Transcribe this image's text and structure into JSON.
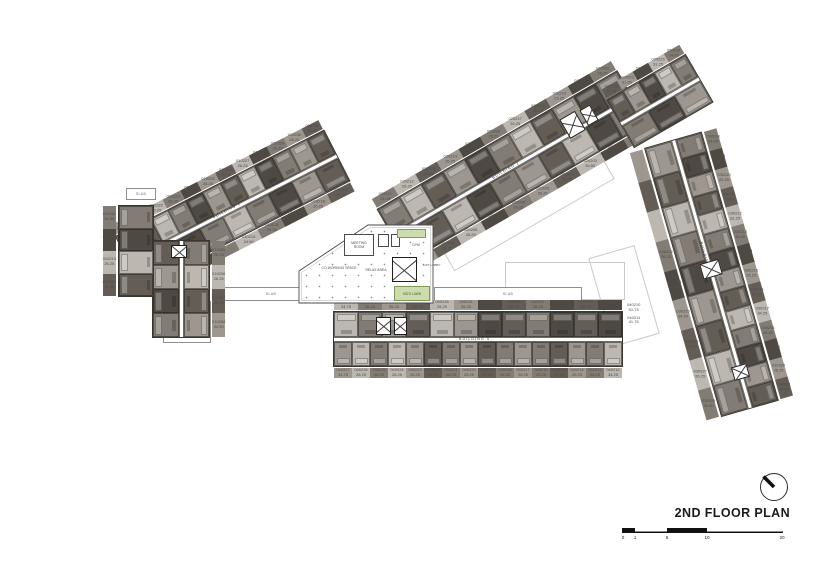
{
  "title": "2ND FLOOR PLAN",
  "scale_bar": {
    "ticks": [
      "0",
      "1",
      "5",
      "10",
      "20"
    ]
  },
  "amenity": {
    "meeting_room": "MEETING ROOM",
    "gym": "GYM",
    "coworking": "CO-WORKING SPACE",
    "relax_area": "RELAX AREA",
    "kids_lawn": "KID'S LAWN",
    "lift_lobby": "LIFT LOBBY",
    "slab": "SLAB"
  },
  "palette": {
    "unit_shades": [
      "#4f4943",
      "#645d56",
      "#837c74",
      "#9e978f",
      "#bcb7b0",
      "#d3cfc9"
    ],
    "lawn_green": "#ccdcae"
  },
  "buildings": {
    "b1": {
      "name": "BUILDING 1",
      "diag_top": [
        {
          "c": "010220",
          "a": "26.25",
          "s": 3
        },
        {
          "c": "010221",
          "a": "26.25",
          "s": 1
        },
        {
          "c": "010222",
          "a": "26.25",
          "s": 4
        },
        {
          "c": "010223",
          "a": "26.25",
          "s": 2
        },
        {
          "c": "010224",
          "a": "26.25",
          "s": 0
        },
        {
          "c": "010225",
          "a": "26.25",
          "s": 3
        },
        {
          "c": "010226",
          "a": "26.25",
          "s": 1
        },
        {
          "c": "010227",
          "a": "26.25",
          "s": 4
        },
        {
          "c": "010228",
          "a": "34.50",
          "s": 0
        },
        {
          "c": "010229",
          "a": "26.25",
          "s": 2
        },
        {
          "c": "010230",
          "a": "26.25",
          "s": 3
        },
        {
          "c": "010231",
          "a": "34.50",
          "s": 1
        }
      ],
      "diag_bot": [
        {
          "s": 1
        },
        {
          "s": 3
        },
        {
          "s": 0
        },
        {
          "s": 2
        },
        {
          "c": "010215",
          "a": "34.50",
          "s": 4
        },
        {
          "c": "010216",
          "a": "26.25",
          "s": 2
        },
        {
          "c": "010217",
          "a": "26.25",
          "s": 0
        },
        {
          "c": "010218",
          "a": "26.25",
          "s": 3
        },
        {
          "c": "010219",
          "a": "26.25",
          "s": 1
        }
      ],
      "left_col": [
        {
          "c": "010211",
          "a": "34.50",
          "s": 2
        },
        {
          "c": "010212",
          "a": "26.25",
          "s": 0
        },
        {
          "c": "010213",
          "a": "26.25",
          "s": 4
        },
        {
          "c": "010214",
          "a": "34.50",
          "s": 1
        }
      ],
      "vert_left": [
        {
          "s": 1
        },
        {
          "s": 3
        },
        {
          "s": 0
        },
        {
          "s": 2
        }
      ],
      "vert_right": [
        {
          "c": "010205",
          "a": "26.25",
          "s": 2
        },
        {
          "c": "010206",
          "a": "26.25",
          "s": 4
        },
        {
          "c": "010207",
          "a": "26.25",
          "s": 1
        },
        {
          "c": "010208",
          "a": "34.50",
          "s": 3
        }
      ]
    },
    "b2": {
      "name": "BUILDING 2",
      "top": [
        {
          "c": "020211",
          "a": "31.05",
          "s": 2
        },
        {
          "c": "020212",
          "a": "26.25",
          "s": 4
        },
        {
          "c": "020213",
          "a": "26.25",
          "s": 1
        },
        {
          "c": "020214",
          "a": "26.25",
          "s": 3
        },
        {
          "c": "020215",
          "a": "26.25",
          "s": 0
        },
        {
          "c": "020216",
          "a": "26.25",
          "s": 2
        },
        {
          "c": "020217",
          "a": "26.25",
          "s": 4
        },
        {
          "c": "020218",
          "a": "26.25",
          "s": 1
        },
        {
          "c": "020219",
          "a": "26.25",
          "s": 3
        },
        {
          "c": "020220",
          "a": "34.50",
          "s": 0
        },
        {
          "c": "020221",
          "a": "28.25",
          "s": 2
        }
      ],
      "bot": [
        {
          "c": "020210",
          "a": "34.05",
          "s": 3
        },
        {
          "c": "020209",
          "a": "26.25",
          "s": 1
        },
        {
          "c": "020208",
          "a": "26.25",
          "s": 4
        },
        {
          "c": "020207",
          "a": "26.25",
          "s": 0
        },
        {
          "c": "020206",
          "a": "26.25",
          "s": 2
        },
        {
          "c": "020205",
          "a": "26.25",
          "s": 3
        },
        {
          "c": "020204",
          "a": "26.25",
          "s": 1
        },
        {
          "c": "020203",
          "a": "34.50",
          "s": 4
        },
        {
          "c": "020202",
          "a": "26.25",
          "s": 0
        },
        {
          "c": "020201",
          "a": "34.50",
          "s": 2
        }
      ],
      "ext": [
        {
          "c": "020222",
          "a": "31.05",
          "s": 1
        },
        {
          "c": "020223",
          "a": "31.25",
          "s": 3
        },
        {
          "c": "020224",
          "a": "31.05",
          "s": 0
        },
        {
          "c": "020225",
          "a": "31.25",
          "s": 4
        },
        {
          "c": "020226",
          "a": "34.05",
          "s": 2
        }
      ],
      "ext_b": [
        {
          "s": 2
        },
        {
          "s": 0
        },
        {
          "s": 3
        }
      ]
    },
    "b3": {
      "name": "BUILDING 3",
      "right": [
        {
          "c": "030208",
          "a": "34.05",
          "s": 2
        },
        {
          "c": "030209",
          "a": "26.25",
          "s": 0
        },
        {
          "c": "030210",
          "a": "26.25",
          "s": 3
        },
        {
          "c": "030211",
          "a": "26.25",
          "s": 1
        },
        {
          "c": "030212",
          "a": "26.25",
          "s": 4
        },
        {
          "c": "030213",
          "a": "34.25",
          "s": 2
        },
        {
          "c": "030214",
          "a": "26.25",
          "s": 0
        },
        {
          "c": "030215",
          "a": "26.25",
          "s": 3
        },
        {
          "c": "030216",
          "a": "26.25",
          "s": 1
        },
        {
          "c": "030217",
          "a": "34.25",
          "s": 4
        },
        {
          "c": "030218",
          "a": "26.25",
          "s": 2
        },
        {
          "c": "030219",
          "a": "26.25",
          "s": 0
        },
        {
          "c": "030220",
          "a": "26.25",
          "s": 3
        },
        {
          "c": "030221",
          "a": "44.75",
          "s": 1
        }
      ],
      "left": [
        {
          "s": 3
        },
        {
          "s": 1
        },
        {
          "s": 4
        },
        {
          "c": "030223",
          "a": "26.25",
          "s": 2
        },
        {
          "c": "030224",
          "a": "26.25",
          "s": 0
        },
        {
          "c": "030225",
          "a": "34.50",
          "s": 3
        },
        {
          "c": "030226",
          "a": "26.25",
          "s": 1
        },
        {
          "c": "030227",
          "a": "26.25",
          "s": 4
        },
        {
          "c": "030228",
          "a": "34.50",
          "s": 2
        }
      ]
    },
    "b4": {
      "name": "BUILDING 4",
      "top": [
        {
          "c": "040229",
          "a": "34.75",
          "s": 4
        },
        {
          "c": "040230",
          "a": "26.25",
          "s": 2
        },
        {
          "c": "040231",
          "a": "26.25",
          "s": 3
        },
        {
          "c": "040232",
          "a": "26.25",
          "s": 1
        },
        {
          "c": "040233",
          "a": "26.25",
          "s": 4
        },
        {
          "c": "040234",
          "a": "26.25",
          "s": 3
        },
        {
          "c": "040235",
          "a": "26.25",
          "s": 0
        },
        {
          "c": "040236",
          "a": "26.25",
          "s": 1
        },
        {
          "c": "040237",
          "a": "26.25",
          "s": 2
        },
        {
          "c": "040238",
          "a": "26.25",
          "s": 0
        },
        {
          "c": "040239",
          "a": "26.25",
          "s": 1
        },
        {
          "c": "040240",
          "a": "24.50",
          "s": 0
        }
      ],
      "bot": [
        {
          "c": "040227",
          "a": "34.75",
          "s": 3
        },
        {
          "c": "040226",
          "a": "26.25",
          "s": 4
        },
        {
          "c": "040225",
          "a": "26.25",
          "s": 2
        },
        {
          "c": "040224",
          "a": "26.25",
          "s": 4
        },
        {
          "c": "040223",
          "a": "26.25",
          "s": 3
        },
        {
          "c": "040222",
          "a": "26.25",
          "s": 1
        },
        {
          "c": "040221",
          "a": "26.25",
          "s": 2
        },
        {
          "c": "040220",
          "a": "26.25",
          "s": 3
        },
        {
          "c": "040219",
          "a": "26.25",
          "s": 1
        },
        {
          "c": "040218",
          "a": "26.25",
          "s": 2
        },
        {
          "c": "040217",
          "a": "26.25",
          "s": 3
        },
        {
          "c": "040216",
          "a": "26.25",
          "s": 2
        },
        {
          "c": "040215",
          "a": "26.25",
          "s": 1
        },
        {
          "c": "040214",
          "a": "26.25",
          "s": 3
        },
        {
          "c": "040213",
          "a": "26.25",
          "s": 2
        },
        {
          "c": "040212",
          "a": "34.25",
          "s": 4
        }
      ],
      "caps": [
        {
          "c": "040210",
          "a": "51.75"
        },
        {
          "c": "040211",
          "a": "41.75"
        }
      ]
    }
  }
}
